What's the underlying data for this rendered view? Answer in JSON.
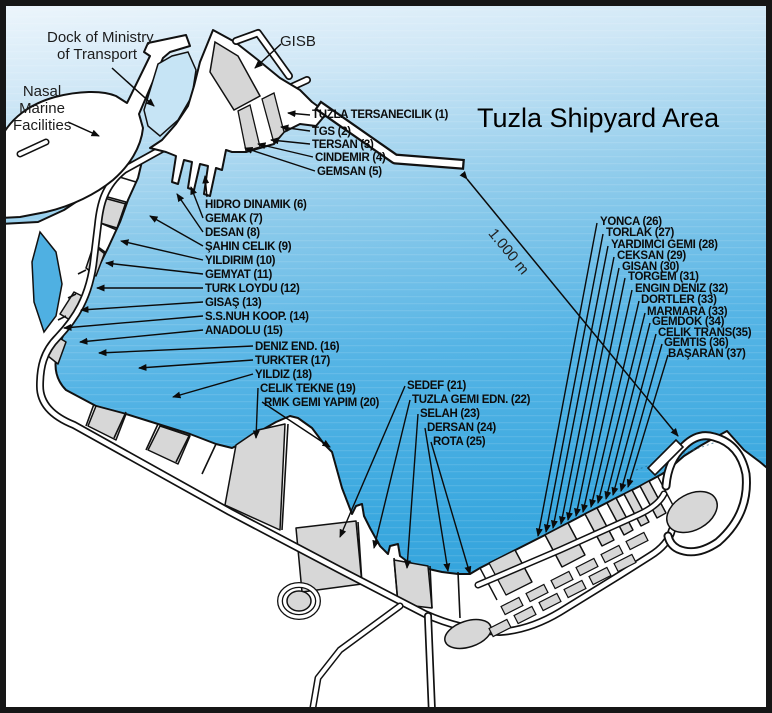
{
  "title": "Tuzla Shipyard Area",
  "annotations": {
    "dock_of_ministry_line1": "Dock of Ministry",
    "dock_of_ministry_line2": "of Transport",
    "nasal_line1": "Nasal",
    "nasal_line2": "Marine",
    "nasal_line3": "Facilities",
    "gisb": "GISB",
    "scale_label": "1.000 m"
  },
  "colors": {
    "water_deep": "#2f9fd9",
    "water_mid": "#55b4e5",
    "water_light": "#eef6fc",
    "land": "#ffffff",
    "parcel_gray": "#d7d7d7",
    "outline": "#111111"
  },
  "facilities": [
    {
      "label": "TUZLA TERSANECILIK (1)"
    },
    {
      "label": "TGS (2)"
    },
    {
      "label": "TERSAN (3)"
    },
    {
      "label": "CINDEMIR (4)"
    },
    {
      "label": "GEMSAN (5)"
    },
    {
      "label": "HIDRO DINAMIK (6)"
    },
    {
      "label": "GEMAK (7)"
    },
    {
      "label": "DESAN (8)"
    },
    {
      "label": "ŞAHIN CELIK (9)"
    },
    {
      "label": "YILDIRIM (10)"
    },
    {
      "label": "GEMYAT (11)"
    },
    {
      "label": "TURK LOYDU (12)"
    },
    {
      "label": "GISAŞ (13)"
    },
    {
      "label": "S.S.NUH KOOP. (14)"
    },
    {
      "label": "ANADOLU (15)"
    },
    {
      "label": "DENIZ END. (16)"
    },
    {
      "label": "TURKTER (17)"
    },
    {
      "label": "YILDIZ (18)"
    },
    {
      "label": "CELIK TEKNE (19)"
    },
    {
      "label": "RMK GEMI YAPIM (20)"
    },
    {
      "label": "SEDEF (21)"
    },
    {
      "label": "TUZLA GEMI EDN. (22)"
    },
    {
      "label": "SELAH (23)"
    },
    {
      "label": "DERSAN (24)"
    },
    {
      "label": "ROTA (25)"
    },
    {
      "label": "YONCA (26)"
    },
    {
      "label": "TORLAK (27)"
    },
    {
      "label": "YARDIMCI GEMI (28)"
    },
    {
      "label": "CEKSAN (29)"
    },
    {
      "label": "GISAN (30)"
    },
    {
      "label": "TORGEM (31)"
    },
    {
      "label": "ENGIN DENIZ (32)"
    },
    {
      "label": "DORTLER (33)"
    },
    {
      "label": "MARMARA (33)"
    },
    {
      "label": "GEMDOK (34)"
    },
    {
      "label": "CELIK TRANS(35)"
    },
    {
      "label": "GEMTIS (36)"
    },
    {
      "label": "BAŞARAN (37)"
    }
  ]
}
